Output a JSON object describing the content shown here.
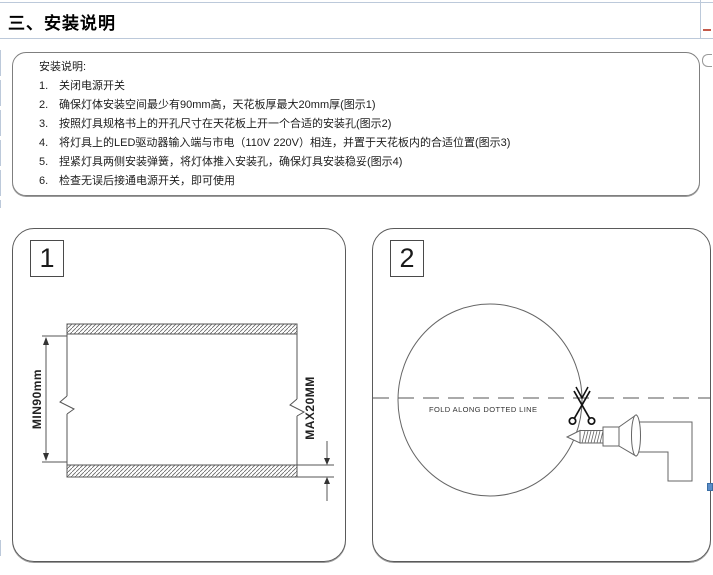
{
  "page": {
    "title": "三、安装说明"
  },
  "instructions": {
    "heading": "安装说明:",
    "items": [
      {
        "num": "1.",
        "text": "关闭电源开关"
      },
      {
        "num": "2.",
        "text": "确保灯体安装空间最少有90mm高，天花板厚最大20mm厚(图示1)"
      },
      {
        "num": "3.",
        "text": "按照灯具规格书上的开孔尺寸在天花板上开一个合适的安装孔(图示2)"
      },
      {
        "num": "4.",
        "text": "将灯具上的LED驱动器输入端与市电（110V 220V）相连，并置于天花板内的合适位置(图示3)"
      },
      {
        "num": "5.",
        "text": "捏紧灯具两侧安装弹簧，将灯体推入安装孔，确保灯具安装稳妥(图示4)"
      },
      {
        "num": "6.",
        "text": "检查无误后接通电源开关，即可使用"
      }
    ]
  },
  "figure1": {
    "label": "1",
    "dim_height": "MIN90mm",
    "dim_thickness": "MAX20MM"
  },
  "figure2": {
    "label": "2",
    "fold_text": "FOLD ALONG DOTTED LINE",
    "scissors_icon": "scissors",
    "drill_icon": "drill-with-screw"
  },
  "colors": {
    "drawing_line": "#5a5a5a",
    "grid_line": "#bcc9da",
    "handle_blue": "#5b8dc8",
    "marker_red": "#c45a4a"
  }
}
